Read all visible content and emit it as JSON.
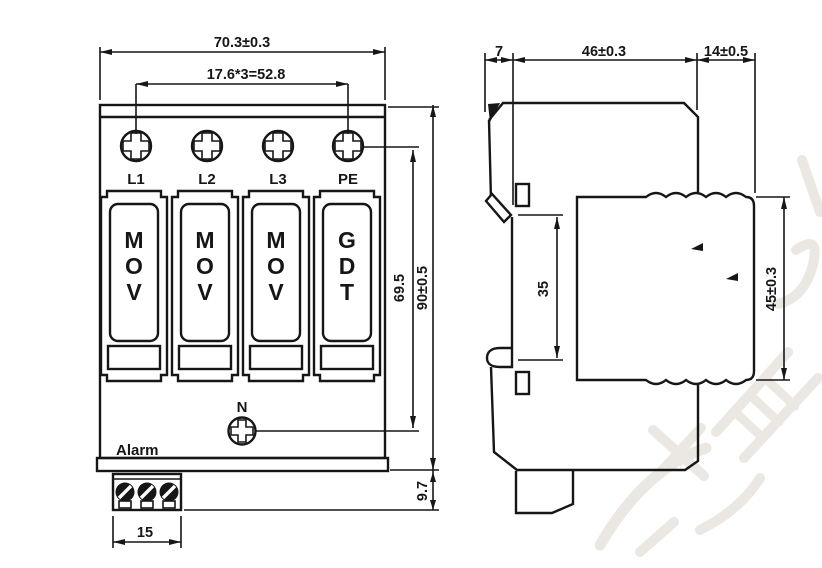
{
  "colors": {
    "indicator_green": "#00e43c",
    "watermark": "#ebe8e3"
  },
  "front_view": {
    "dim_overall_width": "70.3±0.3",
    "dim_module_pitch": "17.6*3=52.8",
    "terminal_labels": [
      "L1",
      "L2",
      "L3",
      "PE"
    ],
    "modules": [
      {
        "letters": [
          "M",
          "O",
          "V"
        ]
      },
      {
        "letters": [
          "M",
          "O",
          "V"
        ]
      },
      {
        "letters": [
          "M",
          "O",
          "V"
        ]
      },
      {
        "letters": [
          "G",
          "D",
          "T"
        ]
      }
    ],
    "neutral_label": "N",
    "alarm_label": "Alarm",
    "dim_terminal_span": "69.5",
    "dim_overall_height": "90±0.5",
    "dim_base_height": "9.7",
    "dim_alarm_block_width": "15"
  },
  "side_view": {
    "dim_clip_offset": "7",
    "dim_body_depth": "46±0.3",
    "dim_module_depth": "14±0.5",
    "dim_din_rail_opening": "35",
    "dim_module_height": "45±0.3"
  },
  "watermark": {
    "text": "份有限"
  }
}
